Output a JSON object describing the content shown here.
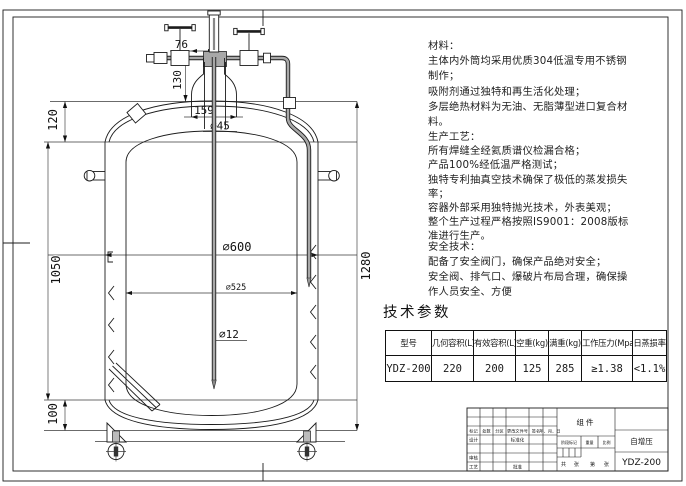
{
  "drawing": {
    "dim_labels": {
      "w76": "76",
      "h130": "130",
      "w159": "159",
      "dia45": "∅45",
      "h120": "120",
      "h1050": "1050",
      "h100": "100",
      "dia600": "∅600",
      "dia525": "∅525",
      "dia12": "∅12",
      "h1280": "1280"
    }
  },
  "notes": {
    "materials": [
      "材料：",
      "主体内外筒均采用优质304低温专用不锈钢",
      "制作；",
      "吸附剂通过独特和再生活化处理；",
      "多层绝热材料为无油、无脂薄型进口复合材",
      "料。"
    ],
    "process": [
      "生产工艺：",
      "所有焊缝全经氦质谱仪检漏合格；",
      "产品100%经低温严格测试；",
      "独特专利抽真空技术确保了极低的蒸发损失",
      "率；",
      "容器外部采用独特抛光技术，外表美观；",
      "整个生产过程严格按照IS9001：2008版标",
      "准进行生产。"
    ],
    "safety": [
      "安全技术：",
      "配备了安全阀门，确保产品绝对安全；",
      "安全阀、排气口、爆破片布局合理，确保操",
      "作人员安全、方便"
    ]
  },
  "params": {
    "heading": "技术参数",
    "headers": [
      "型号",
      "几何容积(L)",
      "有效容积(L)",
      "空重(kg)",
      "满重(kg)",
      "工作压力(Mpa)",
      "日蒸损率"
    ],
    "row": [
      "YDZ-200",
      "220",
      "200",
      "125",
      "285",
      "≥1.38",
      "<1.1%"
    ]
  },
  "titleblock": {
    "component": "组件",
    "product_name": "自增压",
    "model": "YDZ-200",
    "rev_row": [
      "标记",
      "处数",
      "分区",
      "更改文件号",
      "签名",
      "年、月、日"
    ],
    "design": "设计",
    "standardize": "标准化",
    "audit": "审核",
    "craft": "工艺",
    "approve": "批准",
    "stage_mark": "阶段标记",
    "weight": "重量",
    "scale": "比例",
    "sheets": [
      "共",
      "张",
      "第",
      "张"
    ]
  }
}
